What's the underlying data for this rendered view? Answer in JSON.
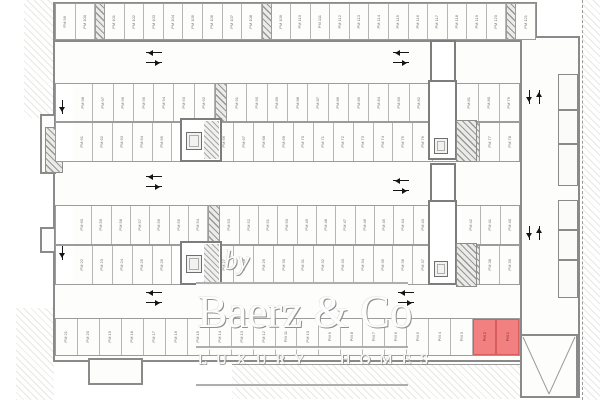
{
  "plan": {
    "type": "underground parking garage floor plan",
    "highlight_color": "#f28080",
    "wall_color": "#8a8a8a",
    "highlighted_stalls": [
      "PM 2",
      "PM 1"
    ],
    "stall_prefix": "PM",
    "stall_range": "PM 1 - PM 121",
    "rows": {
      "top": [
        {
          "s": "PM 99"
        },
        {
          "s": "PM 100"
        },
        {
          "x": 10
        },
        {
          "s": "PM 101"
        },
        {
          "s": "PM 102"
        },
        {
          "s": "PM 103"
        },
        {
          "s": "PM 104"
        },
        {
          "s": "PM 105"
        },
        {
          "s": "PM 106"
        },
        {
          "s": "PM 107"
        },
        {
          "s": "PM 108"
        },
        {
          "x": 10
        },
        {
          "s": "PM 109"
        },
        {
          "s": "PM 110"
        },
        {
          "s": "PM 111"
        },
        {
          "s": "PM 112"
        },
        {
          "s": "PM 113"
        },
        {
          "s": "PM 114"
        },
        {
          "s": "PM 115"
        },
        {
          "s": "PM 116"
        },
        {
          "s": "PM 117"
        },
        {
          "s": "PM 118"
        },
        {
          "s": "PM 119"
        },
        {
          "s": "PM 120"
        },
        {
          "x": 10
        },
        {
          "s": "PM 121"
        }
      ],
      "upper_a": [
        {
          "g": 17
        },
        {
          "s": "PM 98"
        },
        {
          "s": "PM 97"
        },
        {
          "s": "PM 96"
        },
        {
          "s": "PM 95"
        },
        {
          "s": "PM 94"
        },
        {
          "s": "PM 93"
        },
        {
          "s": "PM 92"
        },
        {
          "x": 12
        },
        {
          "s": "PM 91"
        },
        {
          "s": "PM 90"
        },
        {
          "s": "PM 89"
        },
        {
          "s": "PM 88"
        },
        {
          "s": "PM 87"
        },
        {
          "s": "PM 86"
        },
        {
          "s": "PM 85"
        },
        {
          "s": "PM 84"
        },
        {
          "s": "PM 83"
        },
        {
          "s": "PM 82"
        },
        {
          "g": 29
        },
        {
          "s": "PM 81"
        },
        {
          "s": "PM 80"
        },
        {
          "s": "PM 79"
        }
      ],
      "lower_a": [
        {
          "g": 17
        },
        {
          "s": "PM 61"
        },
        {
          "s": "PM 62"
        },
        {
          "s": "PM 63"
        },
        {
          "s": "PM 64"
        },
        {
          "s": "PM 65"
        },
        {
          "g": 42
        },
        {
          "s": "PM 66"
        },
        {
          "s": "PM 67"
        },
        {
          "s": "PM 68"
        },
        {
          "s": "PM 69"
        },
        {
          "s": "PM 70"
        },
        {
          "s": "PM 71"
        },
        {
          "s": "PM 72"
        },
        {
          "s": "PM 73"
        },
        {
          "s": "PM 74"
        },
        {
          "s": "PM 75"
        },
        {
          "s": "PM 76"
        },
        {
          "g": 29
        },
        {
          "x": 18
        },
        {
          "s": "PM 77"
        },
        {
          "s": "PM 78"
        }
      ],
      "upper_b": [
        {
          "g": 17
        },
        {
          "s": "PM 60"
        },
        {
          "s": "PM 59"
        },
        {
          "s": "PM 58"
        },
        {
          "s": "PM 57"
        },
        {
          "s": "PM 56"
        },
        {
          "s": "PM 55"
        },
        {
          "s": "PM 54"
        },
        {
          "x": 12
        },
        {
          "s": "PM 53"
        },
        {
          "s": "PM 52"
        },
        {
          "s": "PM 51"
        },
        {
          "s": "PM 50"
        },
        {
          "s": "PM 49"
        },
        {
          "s": "PM 48"
        },
        {
          "s": "PM 47"
        },
        {
          "s": "PM 46"
        },
        {
          "s": "PM 45"
        },
        {
          "s": "PM 44"
        },
        {
          "s": "PM 43"
        },
        {
          "g": 29
        },
        {
          "s": "PM 42"
        },
        {
          "s": "PM 41"
        },
        {
          "s": "PM 40"
        }
      ],
      "lower_b": [
        {
          "g": 17
        },
        {
          "s": "PM 22"
        },
        {
          "s": "PM 23"
        },
        {
          "s": "PM 24"
        },
        {
          "s": "PM 25"
        },
        {
          "s": "PM 26"
        },
        {
          "g": 42
        },
        {
          "s": "PM 27"
        },
        {
          "s": "PM 28"
        },
        {
          "s": "PM 29"
        },
        {
          "s": "PM 30"
        },
        {
          "s": "PM 31"
        },
        {
          "s": "PM 32"
        },
        {
          "s": "PM 33"
        },
        {
          "s": "PM 34"
        },
        {
          "s": "PM 35"
        },
        {
          "s": "PM 36"
        },
        {
          "s": "PM 37"
        },
        {
          "g": 29
        },
        {
          "x": 18
        },
        {
          "s": "PM 38"
        },
        {
          "s": "PM 39"
        }
      ],
      "bottom": [
        {
          "s": "PM 21"
        },
        {
          "s": "PM 20"
        },
        {
          "s": "PM 19"
        },
        {
          "s": "PM 18"
        },
        {
          "s": "PM 17"
        },
        {
          "s": "PM 16"
        },
        {
          "s": "PM 15"
        },
        {
          "s": "PM 14"
        },
        {
          "s": "PM 13"
        },
        {
          "s": "PM 12"
        },
        {
          "s": "PM 11"
        },
        {
          "s": "PM 10"
        },
        {
          "s": "PM 9"
        },
        {
          "s": "PM 8"
        },
        {
          "s": "PM 7"
        },
        {
          "s": "PM 6"
        },
        {
          "s": "PM 5"
        },
        {
          "s": "PM 4"
        },
        {
          "s": "PM 3"
        },
        {
          "s": "PM 2",
          "r": true
        },
        {
          "s": "PM 1",
          "r": true
        }
      ]
    }
  },
  "watermark": {
    "by": "by",
    "brand": "Baerz & Co",
    "tagline": "LUXURY HOMES"
  }
}
